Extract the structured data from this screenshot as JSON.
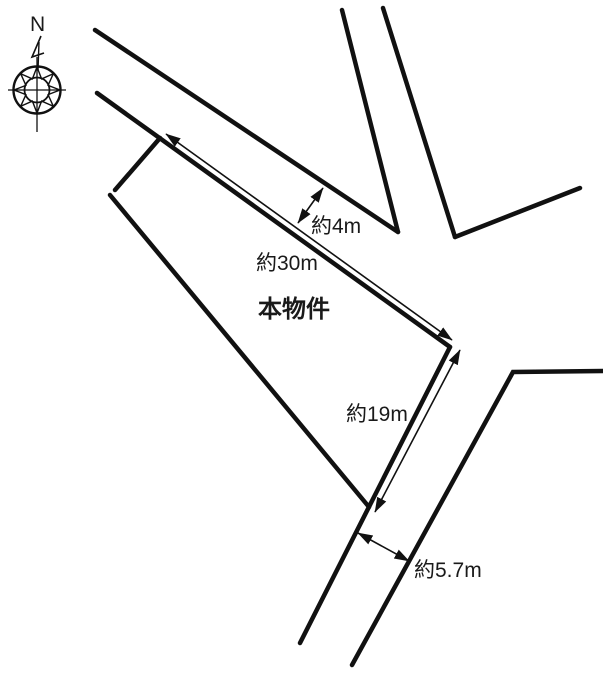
{
  "title": "土地区画図 (land plot diagram)",
  "colors": {
    "background": "#ffffff",
    "line": "#111111",
    "text": "#1a1a1a"
  },
  "compass": {
    "north_label": "N",
    "center": [
      37,
      90
    ],
    "outer_radius": 23.5,
    "inner_radius": 12.5,
    "star_outer_radius": 23,
    "star_inner_radius": 12,
    "crosshair_h": [
      [
        8,
        90
      ],
      [
        66,
        90
      ]
    ],
    "crosshair_v": [
      [
        37,
        57
      ],
      [
        37,
        132
      ]
    ],
    "needle": [
      [
        41,
        36
      ],
      [
        32,
        57
      ],
      [
        44,
        53
      ]
    ],
    "needle_shaft": [
      [
        39,
        42
      ],
      [
        38,
        70
      ]
    ]
  },
  "diagram": {
    "width": 603,
    "height": 673,
    "road_stroke_width": 4.5,
    "arrow_stroke_width": 1.6,
    "segments": [
      {
        "name": "road-upper-north-edge",
        "points": [
          [
            95,
            30
          ],
          [
            398,
            232
          ]
        ]
      },
      {
        "name": "road-upper-south-edge",
        "points": [
          [
            97,
            93
          ],
          [
            450,
            347
          ]
        ]
      },
      {
        "name": "road-northeast-west-edge",
        "points": [
          [
            342,
            10
          ],
          [
            398,
            232
          ]
        ]
      },
      {
        "name": "road-northeast-east-edge",
        "points": [
          [
            383,
            8
          ],
          [
            455,
            237
          ]
        ]
      },
      {
        "name": "road-east-north-edge",
        "points": [
          [
            455,
            237
          ],
          [
            580,
            188
          ]
        ]
      },
      {
        "name": "road-south-west-edge-property-east-boundary",
        "points": [
          [
            300,
            643
          ],
          [
            450,
            347
          ]
        ]
      },
      {
        "name": "road-south-east-edge",
        "points": [
          [
            352,
            665
          ],
          [
            513,
            372
          ],
          [
            603,
            371
          ]
        ]
      },
      {
        "name": "property-northwest-notch-edge",
        "points": [
          [
            160,
            138
          ],
          [
            115,
            190
          ]
        ]
      },
      {
        "name": "property-west-boundary",
        "points": [
          [
            110,
            195
          ],
          [
            369,
            507
          ]
        ]
      }
    ],
    "dimension_arrows": [
      {
        "name": "frontage-dimension-arrow",
        "from": [
          166,
          134
        ],
        "to": [
          452,
          340
        ]
      },
      {
        "name": "east-side-dimension-arrow",
        "from": [
          460,
          350
        ],
        "to": [
          375,
          512
        ]
      },
      {
        "name": "road-width-top-dimension-arrow",
        "from": [
          323,
          188
        ],
        "to": [
          298,
          223
        ]
      },
      {
        "name": "road-width-bottom-dimension-arrow",
        "from": [
          358,
          533
        ],
        "to": [
          409,
          561
        ]
      }
    ],
    "labels": [
      {
        "name": "compass-north-label",
        "text": "N",
        "x": 30,
        "y": 14,
        "size": 21,
        "bold": false
      },
      {
        "name": "road-width-top-label",
        "text": "約4m",
        "x": 311,
        "y": 216,
        "size": 21,
        "bold": false
      },
      {
        "name": "frontage-label",
        "text": "約30m",
        "x": 256,
        "y": 253,
        "size": 21,
        "bold": false
      },
      {
        "name": "property-label",
        "text": "本物件",
        "x": 258,
        "y": 298,
        "size": 24,
        "bold": true
      },
      {
        "name": "east-side-label",
        "text": "約19m",
        "x": 346,
        "y": 404,
        "size": 21,
        "bold": false
      },
      {
        "name": "road-width-bottom-label",
        "text": "約5.7m",
        "x": 414,
        "y": 560,
        "size": 21,
        "bold": false
      }
    ]
  }
}
